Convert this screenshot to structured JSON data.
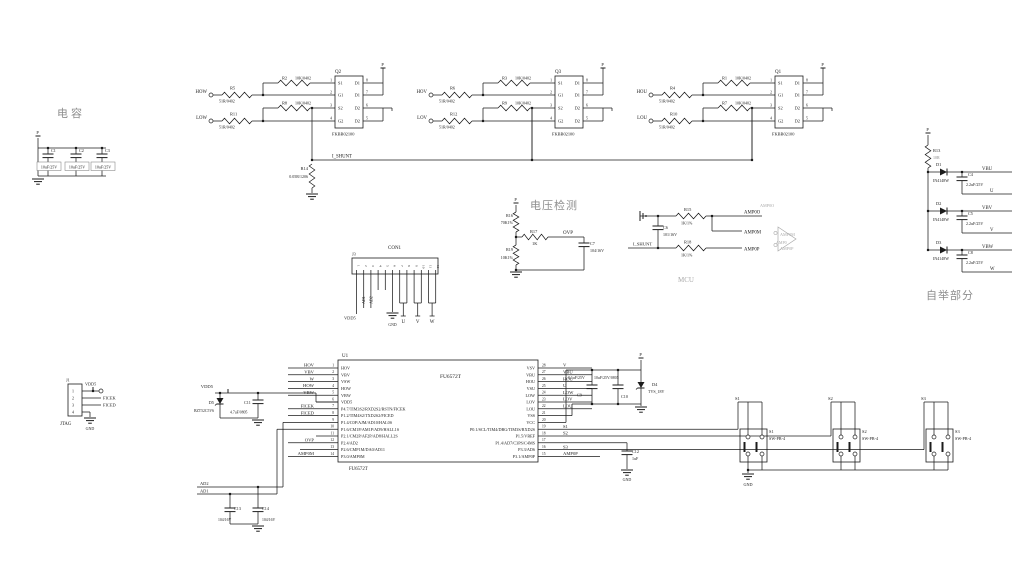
{
  "titles": {
    "cap_section": "电容",
    "vdet_section": "电压检测",
    "bootstrap_section": "自举部分",
    "amp_ghost": "MCU"
  },
  "power_net": "P",
  "gnd_label": "GND",
  "cap_bank": {
    "caps": [
      {
        "ref": "C1",
        "val": "10uF/25V"
      },
      {
        "ref": "C2",
        "val": "10uF/25V"
      },
      {
        "ref": "C3",
        "val": "10uF/25V"
      }
    ]
  },
  "driver_blocks": [
    {
      "ref": "Q2",
      "part": "FKBB02100",
      "in_high": {
        "net": "HOW",
        "r": "R5",
        "val": "51R/0402"
      },
      "in_low": {
        "net": "LOW",
        "r": "R11",
        "val": "51R/0402"
      },
      "gate_high": {
        "r": "R2",
        "val": "10K/0402"
      },
      "gate_low": {
        "r": "R8",
        "val": "10K/0402"
      },
      "pins_left": [
        "S1",
        "G1",
        "S2",
        "G2"
      ],
      "nums_left": [
        "1",
        "2",
        "3",
        "4"
      ],
      "pins_right": [
        "D1",
        "D1",
        "D2",
        "D2"
      ],
      "nums_right": [
        "8",
        "7",
        "6",
        "5"
      ]
    },
    {
      "ref": "Q3",
      "part": "FKBB02100",
      "in_high": {
        "net": "HOV",
        "r": "R6",
        "val": "51R/0402"
      },
      "in_low": {
        "net": "LOV",
        "r": "R12",
        "val": "51R/0402"
      },
      "gate_high": {
        "r": "R3",
        "val": "10K/0402"
      },
      "gate_low": {
        "r": "R9",
        "val": "10K/0402"
      },
      "pins_left": [
        "S1",
        "G1",
        "S2",
        "G2"
      ],
      "nums_left": [
        "1",
        "2",
        "3",
        "4"
      ],
      "pins_right": [
        "D1",
        "D1",
        "D2",
        "D2"
      ],
      "nums_right": [
        "8",
        "7",
        "6",
        "5"
      ]
    },
    {
      "ref": "Q1",
      "part": "FKBB02100",
      "in_high": {
        "net": "HOU",
        "r": "R4",
        "val": "51R/0402"
      },
      "in_low": {
        "net": "LOU",
        "r": "R10",
        "val": "51R/0402"
      },
      "gate_high": {
        "r": "R1",
        "val": "10K/0402"
      },
      "gate_low": {
        "r": "R7",
        "val": "10K/0402"
      },
      "pins_left": [
        "S1",
        "G1",
        "S2",
        "G2"
      ],
      "nums_left": [
        "1",
        "2",
        "3",
        "4"
      ],
      "pins_right": [
        "D1",
        "D1",
        "D2",
        "D2"
      ],
      "nums_right": [
        "8",
        "7",
        "6",
        "5"
      ]
    }
  ],
  "shunt": {
    "ref": "R14",
    "val": "0.05R/1206",
    "net": "I_SHUNT"
  },
  "vdet": {
    "r_top": {
      "ref": "R16",
      "val": "70K1%"
    },
    "r_series": {
      "ref": "R17",
      "val": "1K"
    },
    "r_bot": {
      "ref": "R19",
      "val": "10K1%"
    },
    "cap": {
      "ref": "C7",
      "val": "104/16V"
    },
    "net": "OVP"
  },
  "con1": {
    "ref": "J3",
    "title": "CON1",
    "pins": [
      "1",
      "2",
      "3",
      "4",
      "5",
      "6",
      "7",
      "8",
      "9",
      "10",
      "11",
      "12"
    ],
    "vdd": "VDD5",
    "ad1": "AD1",
    "ad2": "AD2",
    "u": "U",
    "v": "V",
    "w": "W"
  },
  "sense": {
    "cap": {
      "ref": "C6",
      "val": "101/16V"
    },
    "r_top": {
      "ref": "R15",
      "val": "1K/1%"
    },
    "r_bot": {
      "ref": "R18",
      "val": "1K/1%"
    },
    "net_in": "I_SHUNT",
    "net_out": "AMP0O",
    "net_m": "AMP0M",
    "net_p": "AMP0P",
    "ghost": {
      "out": "AMP0O",
      "m": "AMP0M",
      "amp": "AMP0",
      "p": "AMP0P"
    }
  },
  "bootstrap": {
    "r": {
      "ref": "R13",
      "val": "10R"
    },
    "diode_part": "IN4148W",
    "branches": [
      {
        "d": "D1",
        "net": "VBU",
        "c": "C4",
        "cval": "2.2uF/25V",
        "phase": "U"
      },
      {
        "d": "D2",
        "net": "VBV",
        "c": "C5",
        "cval": "2.2uF/25V",
        "phase": "V"
      },
      {
        "d": "D3",
        "net": "VBW",
        "c": "C8",
        "cval": "2.2uF/25V",
        "phase": "W"
      }
    ]
  },
  "mcu": {
    "ref": "U1",
    "part": "FU6572T",
    "rows": [
      {
        "ln": "1",
        "lname": "HOV",
        "lnet": "HOV",
        "rn": "28",
        "rname": "VSV",
        "rnet": "V"
      },
      {
        "ln": "2",
        "lname": "VBV",
        "lnet": "VBV",
        "rn": "27",
        "rname": "VBU",
        "rnet": "VBU"
      },
      {
        "ln": "3",
        "lname": "VSW",
        "lnet": "W",
        "rn": "26",
        "rname": "HOU",
        "rnet": "HOU"
      },
      {
        "ln": "4",
        "lname": "HOW",
        "lnet": "HOW",
        "rn": "25",
        "rname": "VSU",
        "rnet": "U"
      },
      {
        "ln": "5",
        "lname": "VBW",
        "lnet": "VBW",
        "rn": "24",
        "rname": "LOW",
        "rnet": "LOW"
      },
      {
        "ln": "6",
        "lname": "VDD5",
        "lnet": "",
        "rn": "23",
        "rname": "LOV",
        "rnet": "LOV"
      },
      {
        "ln": "7",
        "lname": "P4.7/TIM3S2/RXD2S2/RSTN/FICEK",
        "lnet": "FICEK",
        "rn": "22",
        "rname": "LOU",
        "rnet": "LOU"
      },
      {
        "ln": "8",
        "lname": "P1.2/TIM4S2/TXD2S2/FICED",
        "lnet": "FICED",
        "rn": "21",
        "rname": "VSS",
        "rnet": ""
      },
      {
        "ln": "9",
        "lname": "P1.4/C0P/AJM/AD10/HAL0S",
        "lnet": "",
        "rn": "20",
        "rname": "VCC",
        "rnet": ""
      },
      {
        "ln": "10",
        "lname": "P1.6/CM1P/AM1P/AD9/HALL1S",
        "lnet": "",
        "rn": "19",
        "rname": "P0.1/SCL/TIM4/DBG/TIM3S/RXD2S",
        "rnet": "S1"
      },
      {
        "ln": "11",
        "lname": "P2.1/CM2P/AF2P/AD8/HALL2S",
        "lnet": "",
        "rn": "18",
        "rname": "P1.5/VREF",
        "rnet": "S2"
      },
      {
        "ln": "12",
        "lname": "P2.4/AD2",
        "lnet": "OVP",
        "rn": "17",
        "rname": "P1.4/AD7/C3PS/C4MS",
        "rnet": ""
      },
      {
        "ln": "13",
        "lname": "P2.6/CMP1M/DA0/AD11",
        "lnet": "",
        "rn": "16",
        "rname": "P3.3/AD6",
        "rnet": "S3"
      },
      {
        "ln": "14",
        "lname": "P3.0/AMP0M",
        "lnet": "AMP0M",
        "rn": "15",
        "rname": "P3.1/AMP0P",
        "rnet": "AMP0P"
      }
    ]
  },
  "vdd5": {
    "net": "VDD5",
    "d": {
      "ref": "D5",
      "val": "BZT52C5V6"
    },
    "c": {
      "ref": "C11",
      "val": "4.7uF/0805"
    }
  },
  "decap": {
    "c9": {
      "ref": "C9",
      "val": "0.1uF/25V"
    },
    "c10": {
      "ref": "C10",
      "val": "10uF/25V/0805"
    },
    "d4": {
      "ref": "D4",
      "val": "TVS_18V"
    },
    "c12": {
      "ref": "C12",
      "val": "1uF"
    }
  },
  "jtag": {
    "ref": "J1",
    "title": "JTAG",
    "pins": [
      "1",
      "2",
      "3",
      "4"
    ],
    "n1": "VDD5",
    "n2": "FICEK",
    "n3": "FICED"
  },
  "ad_filter": {
    "ad2": "AD2",
    "ad1": "AD1",
    "c13": {
      "ref": "C13",
      "val": "104/16V"
    },
    "c14": {
      "ref": "C14",
      "val": "104/16V"
    }
  },
  "switches": {
    "part": "SW-PB-4",
    "items": [
      {
        "net": "S1",
        "ref": "S1"
      },
      {
        "net": "S2",
        "ref": "S2"
      },
      {
        "net": "S3",
        "ref": "S3"
      }
    ]
  }
}
